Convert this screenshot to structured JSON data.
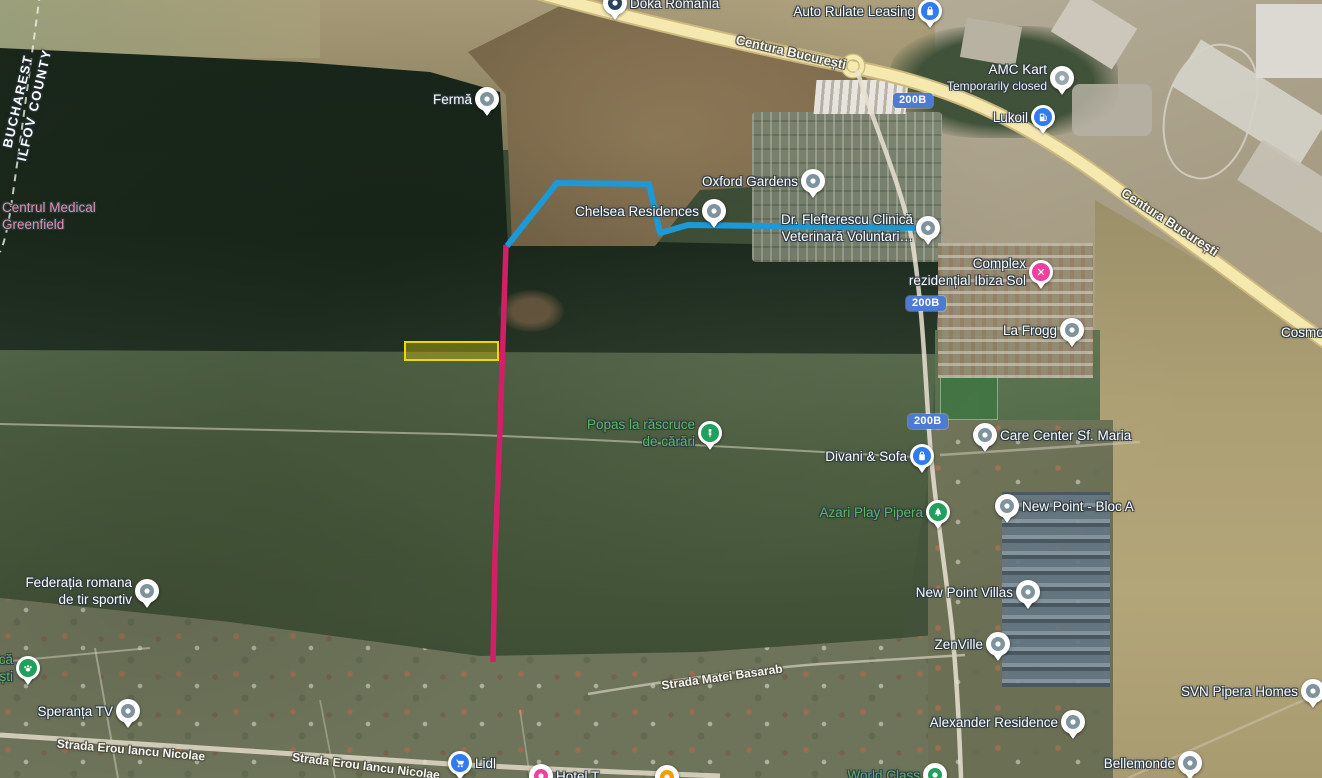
{
  "map_overlay_colors": {
    "route_blue": "#1c99d6",
    "line_magenta": "#d51e68",
    "highlight_yellow_stroke": "#ecd707",
    "highlight_yellow_fill": "rgba(214,197,4,0.38)",
    "badge_blue": "#4d7bd2"
  },
  "marker_colors": {
    "gray": "#7e939e",
    "lightgray": "#98a6ad",
    "blue": "#2e7cf0",
    "green": "#1fa05c",
    "pink": "#f03fa0",
    "orange": "#f49d00",
    "navy": "#2c4257"
  },
  "region_label": {
    "line1": "BUCHAREST",
    "line2": "ILFOV COUNTY"
  },
  "street_labels": [
    {
      "text": "Centura București",
      "x": 791,
      "y": 52,
      "rot": 13,
      "size": 13
    },
    {
      "text": "Centura București",
      "x": 1170,
      "y": 222,
      "rot": 33,
      "size": 13
    },
    {
      "text": "Strada Erou Iancu Nicolae",
      "x": 131,
      "y": 750,
      "rot": 5,
      "size": 12
    },
    {
      "text": "Strada Erou Iancu Nicolae",
      "x": 366,
      "y": 766,
      "rot": 7,
      "size": 12
    },
    {
      "text": "Strada Matei Basarab",
      "x": 722,
      "y": 677,
      "rot": -8,
      "size": 12
    }
  ],
  "road_badges": {
    "label": "200B",
    "positions": [
      [
        912,
        102
      ],
      [
        925,
        305
      ],
      [
        927,
        423
      ]
    ],
    "partial_badge": {
      "x": 856,
      "y": 772
    }
  },
  "pois": [
    {
      "id": "doka-romania",
      "lines": [
        "Doka Romania"
      ],
      "side": "right",
      "color": "white",
      "marker": {
        "color": "navy",
        "icon": "dot"
      },
      "x": 615,
      "y": 3
    },
    {
      "id": "auto-rulate-leasing",
      "lines": [
        "Auto Rulate Leasing"
      ],
      "side": "left",
      "color": "white",
      "marker": {
        "color": "blue",
        "icon": "bag"
      },
      "x": 930,
      "y": 11
    },
    {
      "id": "amc-kart",
      "lines": [
        "AMC Kart"
      ],
      "sub": "Temporarily closed",
      "side": "left",
      "color": "white",
      "marker": {
        "color": "lightgray",
        "icon": "dot"
      },
      "x": 1062,
      "y": 78
    },
    {
      "id": "lukoil",
      "lines": [
        "Lukoil"
      ],
      "side": "left",
      "color": "white",
      "marker": {
        "color": "blue",
        "icon": "fuel"
      },
      "x": 1043,
      "y": 117
    },
    {
      "id": "ferma",
      "lines": [
        "Fermă"
      ],
      "side": "left",
      "color": "white",
      "marker": {
        "color": "gray",
        "icon": "dot"
      },
      "x": 487,
      "y": 99
    },
    {
      "id": "oxford-gardens",
      "lines": [
        "Oxford Gardens"
      ],
      "side": "left",
      "color": "white",
      "marker": {
        "color": "gray",
        "icon": "dot"
      },
      "x": 813,
      "y": 181
    },
    {
      "id": "chelsea-residences",
      "lines": [
        "Chelsea Residences"
      ],
      "side": "left",
      "color": "white",
      "marker": {
        "color": "gray",
        "icon": "dot"
      },
      "x": 714,
      "y": 211
    },
    {
      "id": "flefterescu-vet-clinic",
      "lines": [
        "Dr. Flefterescu Clinică",
        "Veterinară Voluntari…"
      ],
      "side": "left",
      "color": "white",
      "marker": {
        "color": "gray",
        "icon": "dot"
      },
      "x": 928,
      "y": 228
    },
    {
      "id": "complex-ibiza-sol",
      "lines": [
        "Complex",
        "rezidențial Ibiza Sol"
      ],
      "side": "left",
      "color": "white",
      "marker": {
        "color": "pink",
        "icon": "tools"
      },
      "x": 1041,
      "y": 272
    },
    {
      "id": "la-frogg",
      "lines": [
        "La Frogg"
      ],
      "side": "left",
      "color": "white",
      "marker": {
        "color": "gray",
        "icon": "dot"
      },
      "x": 1072,
      "y": 330
    },
    {
      "id": "care-center-sf-maria",
      "lines": [
        "Care Center Sf. Maria"
      ],
      "side": "right",
      "color": "white",
      "marker": {
        "color": "gray",
        "icon": "dot"
      },
      "x": 985,
      "y": 435
    },
    {
      "id": "popas-la-rascruce",
      "lines": [
        "Popas la răscruce",
        "de cărări"
      ],
      "side": "left",
      "color": "green",
      "marker": {
        "color": "green",
        "icon": "picnic"
      },
      "x": 710,
      "y": 433
    },
    {
      "id": "divani-sofa",
      "lines": [
        "Divani & Sofa"
      ],
      "side": "left",
      "color": "white",
      "marker": {
        "color": "blue",
        "icon": "bag"
      },
      "x": 922,
      "y": 456
    },
    {
      "id": "azari-play-pipera",
      "lines": [
        "Azari Play Pipera"
      ],
      "side": "left",
      "color": "green",
      "marker": {
        "color": "green",
        "icon": "tree"
      },
      "x": 938,
      "y": 512
    },
    {
      "id": "new-point-bloc-a",
      "lines": [
        "New Point - Bloc A"
      ],
      "side": "right",
      "color": "white",
      "marker": {
        "color": "gray",
        "icon": "dot"
      },
      "x": 1007,
      "y": 506
    },
    {
      "id": "new-point-villas",
      "lines": [
        "New Point Villas"
      ],
      "side": "left",
      "color": "white",
      "marker": {
        "color": "gray",
        "icon": "dot"
      },
      "x": 1028,
      "y": 592
    },
    {
      "id": "zenville",
      "lines": [
        "ZenVille"
      ],
      "side": "left",
      "color": "white",
      "marker": {
        "color": "gray",
        "icon": "dot"
      },
      "x": 998,
      "y": 644
    },
    {
      "id": "federatia-tir-sportiv",
      "lines": [
        "Federația romana",
        "de tir sportiv"
      ],
      "side": "left",
      "color": "white",
      "marker": {
        "color": "gray",
        "icon": "dot"
      },
      "x": 147,
      "y": 591
    },
    {
      "id": "dog-park-partial",
      "lines": [
        "că",
        "ști"
      ],
      "side": "left",
      "color": "green",
      "marker": {
        "color": "green",
        "icon": "paw"
      },
      "x": 28,
      "y": 668
    },
    {
      "id": "speranta-tv",
      "lines": [
        "Speranța TV"
      ],
      "side": "left",
      "color": "white",
      "marker": {
        "color": "gray",
        "icon": "dot"
      },
      "x": 128,
      "y": 711
    },
    {
      "id": "svn-pipera-homes",
      "lines": [
        "SVN Pipera Homes"
      ],
      "side": "left",
      "color": "white",
      "marker": {
        "color": "gray",
        "icon": "dot"
      },
      "x": 1313,
      "y": 691
    },
    {
      "id": "alexander-residence",
      "lines": [
        "Alexander Residence"
      ],
      "side": "left",
      "color": "white",
      "marker": {
        "color": "gray",
        "icon": "dot"
      },
      "x": 1073,
      "y": 722
    },
    {
      "id": "bellemonde",
      "lines": [
        "Bellemonde"
      ],
      "side": "left",
      "color": "white",
      "marker": {
        "color": "gray",
        "icon": "dot"
      },
      "x": 1190,
      "y": 763
    },
    {
      "id": "lidl",
      "lines": [
        "Lidl"
      ],
      "side": "right",
      "color": "white",
      "marker": {
        "color": "blue",
        "icon": "cart"
      },
      "x": 460,
      "y": 763
    },
    {
      "id": "hotel-partial",
      "lines": [
        "Hotel T"
      ],
      "side": "right",
      "color": "white",
      "marker": {
        "color": "pink",
        "icon": "dot"
      },
      "x": 541,
      "y": 776
    },
    {
      "id": "orange-poi-partial",
      "lines": [],
      "side": "right",
      "color": "white",
      "marker": {
        "color": "orange",
        "icon": "dot"
      },
      "x": 667,
      "y": 777
    },
    {
      "id": "world-class",
      "lines": [
        "World Class"
      ],
      "side": "left",
      "color": "green",
      "marker": {
        "color": "green",
        "icon": "dot"
      },
      "x": 935,
      "y": 775
    },
    {
      "id": "cosmo-partial",
      "lines": [
        "Cosmo"
      ],
      "side": "right",
      "color": "white",
      "marker": null,
      "x": 1281,
      "y": 332
    },
    {
      "id": "centrul-medical-greenfield",
      "lines": [
        "Centrul Medical",
        "Greenfield"
      ],
      "side": "right",
      "color": "pink",
      "marker": null,
      "x": 2,
      "y": 216
    }
  ],
  "overlays": {
    "highlight_rect": {
      "x": 405,
      "y": 342,
      "w": 93,
      "h": 18
    },
    "magenta_path": {
      "points": [
        [
          506,
          245
        ],
        [
          500,
          430
        ],
        [
          495,
          555
        ],
        [
          493,
          662
        ]
      ],
      "width": 5.5
    },
    "blue_path": {
      "points": [
        [
          507,
          246
        ],
        [
          557,
          183
        ],
        [
          649,
          184
        ],
        [
          660,
          233
        ],
        [
          688,
          225
        ],
        [
          928,
          228
        ]
      ],
      "width": 6
    }
  }
}
